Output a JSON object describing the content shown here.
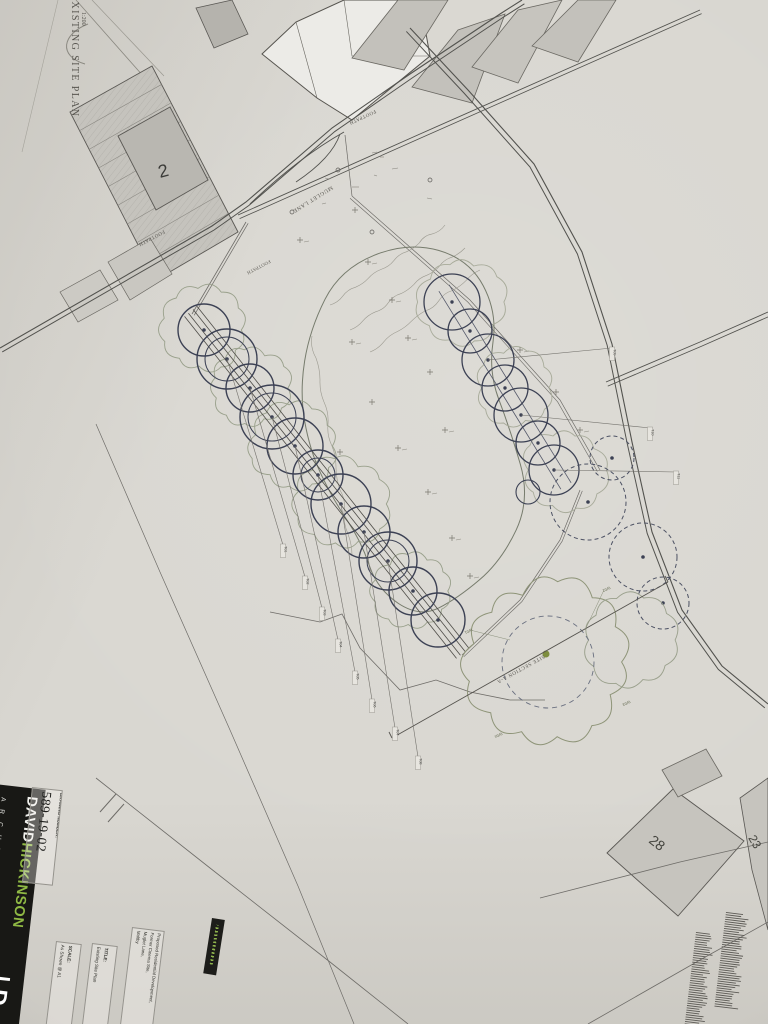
{
  "sheet": {
    "corner_title": "EXISTING SITE PLAN",
    "corner_scale": "1:200"
  },
  "plan": {
    "street_labels": {
      "muglet_lane": "MUGLET LANE",
      "footpath_top": "FOOTPATH",
      "footpath_west": "FOOTPATH",
      "footpath_south": "FOOTPATH"
    },
    "section_label": "SITE SECTION A-A",
    "building_numbers": {
      "plot2": "2",
      "plot28": "28",
      "plot23": "23"
    },
    "tree_tags_left": [
      "T01",
      "T02",
      "T03",
      "T04",
      "T05",
      "T06",
      "T07",
      "T08"
    ],
    "tree_tags_right": [
      "T09",
      "T10",
      "T11"
    ],
    "canopy_tags": [
      "W01",
      "W02",
      "W03",
      "W04"
    ]
  },
  "titleblock": {
    "drawing_number_label": "DRAWING NUMBER:",
    "drawing_number": "589-19-02",
    "brand": {
      "first": "DAVID",
      "last": "HICKINSON",
      "sub": "A R C H I T E C T U R E",
      "glyph": "D"
    },
    "project_label": "PROJECT:",
    "project_lines": [
      "Proposed Residential Development,",
      "Former Cinema Site,",
      "Muglet Lane,",
      "Maltby"
    ],
    "title_label": "TITLE:",
    "title_value": "Existing Site Plan",
    "scale_label": "SCALE:",
    "scale_value": "As Shown @ A1"
  },
  "colors": {
    "brand_green": "#8fb944",
    "paper": "#d9d7d1",
    "road_ink": "#52524e",
    "tree_ink": "#3c4154",
    "canopy": "#99a08b",
    "olive_dot": "#7d8d3e"
  }
}
